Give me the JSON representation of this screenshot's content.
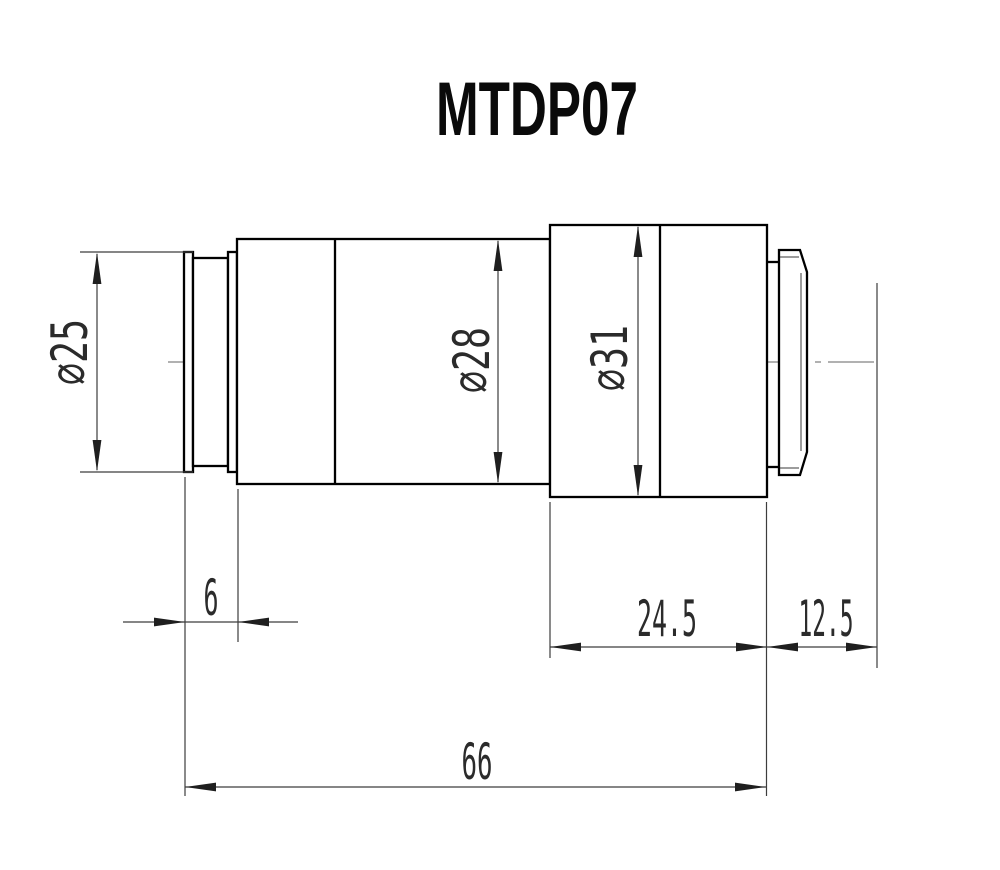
{
  "title": "MTDP07",
  "dimensions": {
    "diameters": [
      {
        "id": "front-flange-diameter",
        "label": "⌀25",
        "value": 25
      },
      {
        "id": "main-barrel-diameter",
        "label": "⌀28",
        "value": 28
      },
      {
        "id": "mount-section-diameter",
        "label": "⌀31",
        "value": 31
      }
    ],
    "lengths": [
      {
        "id": "flange-offset-length",
        "label": "6",
        "value": 6
      },
      {
        "id": "mount-section-length",
        "label": "24.5",
        "value": 24.5
      },
      {
        "id": "back-flange-distance",
        "label": "12.5",
        "value": 12.5
      },
      {
        "id": "overall-length",
        "label": "66",
        "value": 66
      }
    ]
  },
  "colors": {
    "background": "#ffffff",
    "outline": "#000000",
    "dimension_lines": "#3d3d3d",
    "center_line": "#828282",
    "text": "#2b2b2b"
  }
}
